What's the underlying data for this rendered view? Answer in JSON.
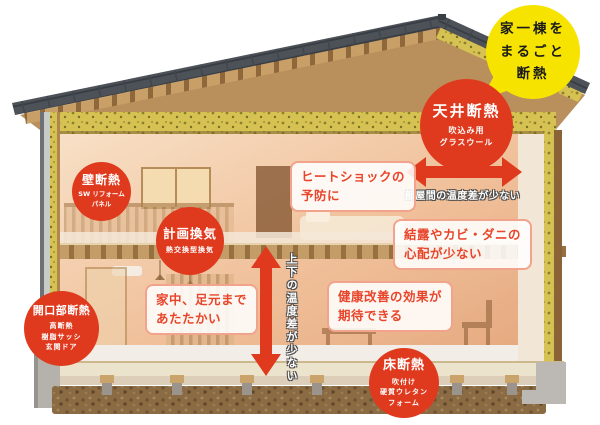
{
  "bubble": {
    "line1": "家一棟を",
    "line2": "まるごと",
    "line3": "断熱"
  },
  "badges": {
    "ceiling": {
      "title": "天井断熱",
      "sub1": "吹込み用",
      "sub2": "グラスウール"
    },
    "wall": {
      "title": "壁断熱",
      "sub1": "SW リフォーム",
      "sub2": "パネル"
    },
    "ventilation": {
      "title": "計画換気",
      "sub1": "熱交換型換気"
    },
    "opening": {
      "title": "開口部断熱",
      "sub1": "高断熱",
      "sub2": "樹脂サッシ",
      "sub3": "玄関ドア"
    },
    "floor": {
      "title": "床断熱",
      "sub1": "吹付け",
      "sub2": "硬質ウレタン",
      "sub3": "フォーム"
    }
  },
  "benefits": {
    "heatshock": {
      "line1": "ヒートショックの",
      "line2": "予防に"
    },
    "condensation": {
      "line1": "結露やカビ・ダニの",
      "line2": "心配が少ない"
    },
    "warm": {
      "line1": "家中、足元まで",
      "line2": "あたたかい"
    },
    "health": {
      "line1": "健康改善の効果が",
      "line2": "期待できる"
    }
  },
  "captions": {
    "rooms_temp_diff": "部屋間の温度差が少ない",
    "vertical_temp_diff": "上下の温度差が少ない"
  },
  "colors": {
    "accent_red": "#e03a1e",
    "bubble_yellow": "#f6e400",
    "benefit_text": "#e8452a",
    "benefit_border": "#f2a38b",
    "insulation_yellow": "#d5c253",
    "roof_gray": "#4d5158"
  }
}
